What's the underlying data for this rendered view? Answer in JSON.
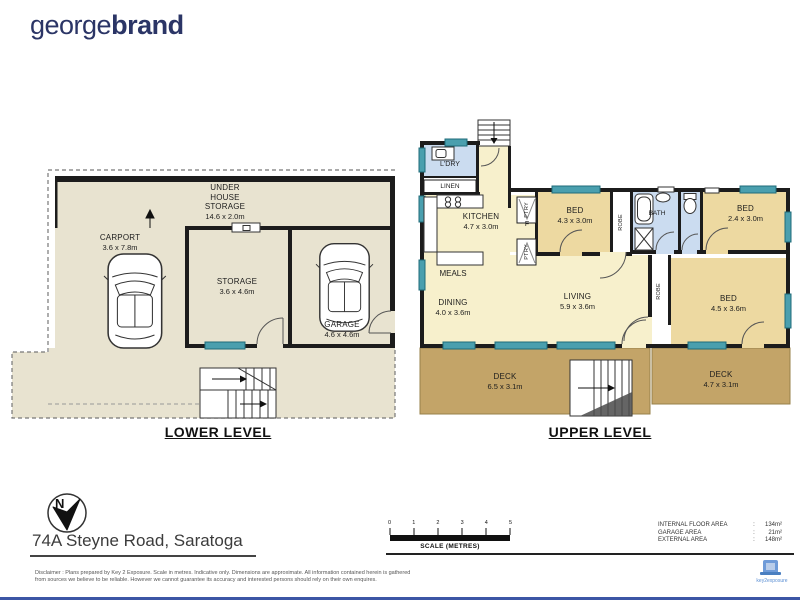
{
  "brand": {
    "part1": "george",
    "part2": "brand"
  },
  "north_label": "N",
  "address": "74A Steyne Road, Saratoga",
  "lower": {
    "title": "LOWER LEVEL",
    "uhs_l1": "UNDER",
    "uhs_l2": "HOUSE",
    "uhs_l3": "STORAGE",
    "uhs_dim": "14.6 x 2.0m",
    "carport": "CARPORT",
    "carport_dim": "3.6 x 7.8m",
    "storage": "STORAGE",
    "storage_dim": "3.6 x 4.6m",
    "garage": "GARAGE",
    "garage_dim": "4.6 x 4.6m"
  },
  "upper": {
    "title": "UPPER LEVEL",
    "ldry": "L'DRY",
    "linen": "LINEN",
    "kitchen": "KITCHEN",
    "kitchen_dim": "4.7 x 3.0m",
    "ptry": "PTRY",
    "fridge": "F",
    "bed1": "BED",
    "bed1_dim": "4.3 x 3.0m",
    "robe1": "ROBE",
    "bath": "BATH",
    "bed2": "BED",
    "bed2_dim": "2.4 x 3.0m",
    "meals": "MEALS",
    "dining": "DINING",
    "dining_dim": "4.0 x 3.6m",
    "living": "LIVING",
    "living_dim": "5.9 x 3.6m",
    "robe2": "ROBE",
    "bed3": "BED",
    "bed3_dim": "4.5 x 3.6m",
    "deck1": "DECK",
    "deck1_dim": "6.5 x 3.1m",
    "deck2": "DECK",
    "deck2_dim": "4.7 x 3.1m"
  },
  "scale": {
    "ticks": [
      "0",
      "1",
      "2",
      "3",
      "4",
      "5"
    ],
    "label": "SCALE (METRES)"
  },
  "areas": {
    "r1_label": "INTERNAL FLOOR AREA",
    "r1_value": "134m²",
    "r2_label": "GARAGE AREA",
    "r2_value": "21m²",
    "r3_label": "EXTERNAL AREA",
    "r3_value": "148m²"
  },
  "disclaimer": {
    "l1": "Disclaimer : Plans prepared by Key 2 Exposure. Scale in metres. Indicative only. Dimensions are approximate. All information contained herein is gathered",
    "l2": "from sources we believe to be reliable. However we cannot guarantee its accuracy and interested persons should rely on their own enquires."
  },
  "footer_logo": "key2exposure",
  "colors": {
    "brand_navy": "#2b3566",
    "cream_lower": "#e8e3d0",
    "cream_upper": "#f7f0cc",
    "bedroom_tan": "#edd9a1",
    "wet_area_blue": "#cbdcf0",
    "deck_brown": "#c3a468",
    "window_teal": "#4a9fae",
    "wall_black": "#1c1c1c",
    "footer_bar_blue": "#3c56a5"
  }
}
